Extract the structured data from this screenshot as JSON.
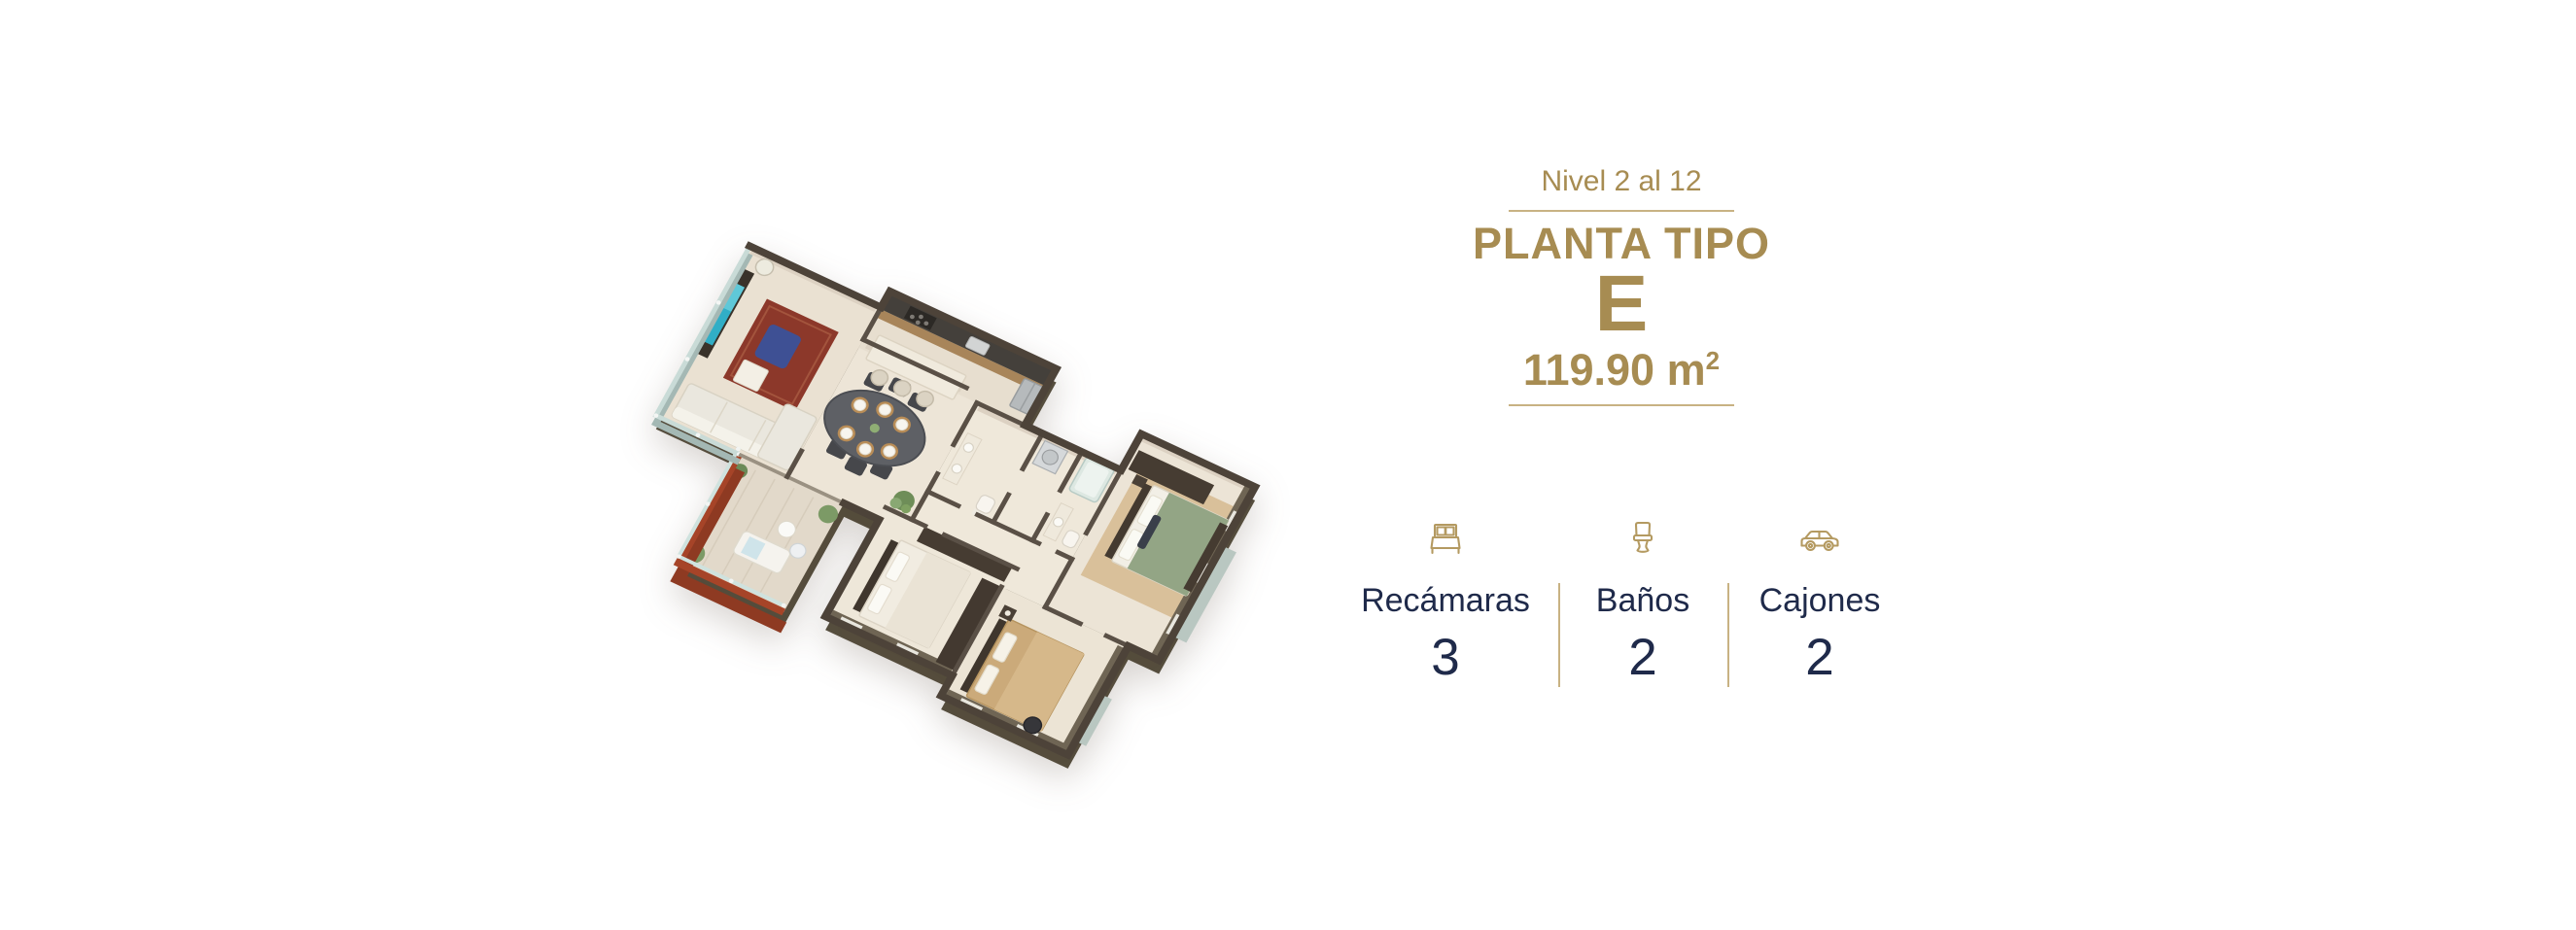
{
  "page": {
    "background": "#ffffff"
  },
  "header": {
    "level_label": "Nivel 2 al 12",
    "title": "PLANTA TIPO",
    "type_letter": "E",
    "area_value": "119.90 m",
    "area_superscript": "2"
  },
  "stats": {
    "items": [
      {
        "icon": "bed-icon",
        "label": "Recámaras",
        "value": "3"
      },
      {
        "icon": "toilet-icon",
        "label": "Baños",
        "value": "2"
      },
      {
        "icon": "car-icon",
        "label": "Cajones",
        "value": "2"
      }
    ]
  },
  "floorplan": {
    "description": "3D isometric render of apartment type E: living room with TV and red rug, dining table for six, kitchen with island, red-walled balcony with glass railing, two bathrooms, and three bedrooms (white, tan and green beds)",
    "colors": {
      "wall_dark": "#4d4339",
      "wall_olive": "#6f6554",
      "wall_inner_beige": "#dcd1c2",
      "floor_cream": "#ece4d6",
      "balcony_red": "#a64428",
      "glass": "#c9dbd7",
      "bed_green": "#93a585",
      "bed_tan": "#cbaa7a",
      "bed_white": "#f1ece1",
      "rug_red": "#8c382a",
      "tv_teal": "#31aec6"
    }
  },
  "theme": {
    "gold": "#a78c52",
    "gold_line": "#c8b283",
    "navy": "#1f2a4a"
  }
}
